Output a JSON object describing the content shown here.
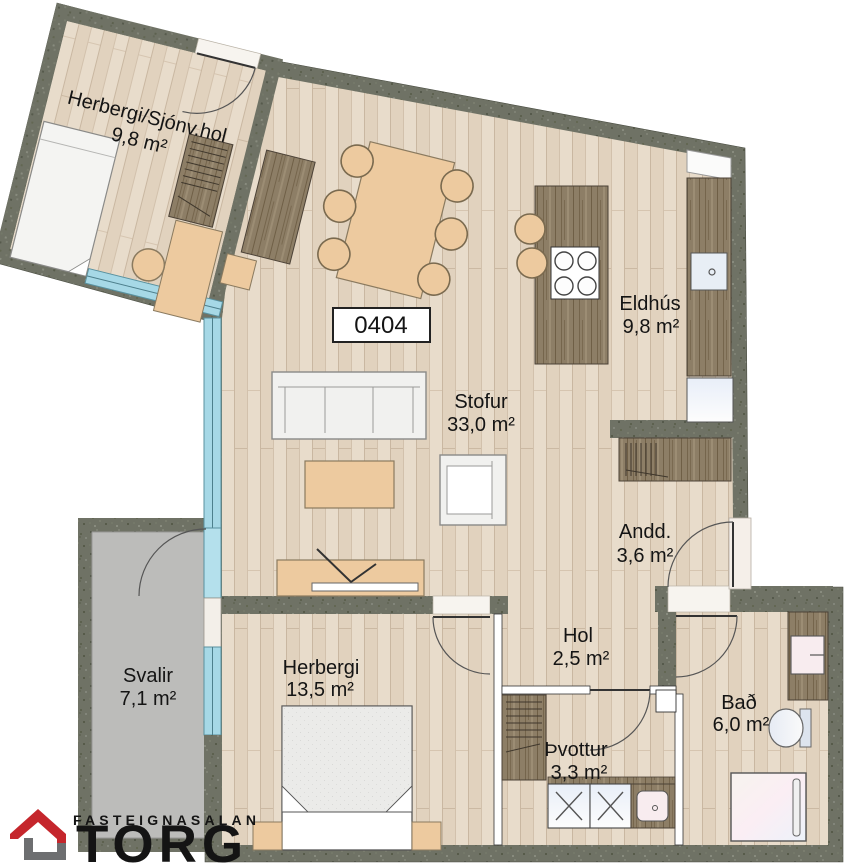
{
  "plan": {
    "unit_label": "0404",
    "rooms": [
      {
        "name": "Herbergi/Sjónv.hol",
        "area": "9,8 m²"
      },
      {
        "name": "Eldhús",
        "area": "9,8 m²"
      },
      {
        "name": "Stofur",
        "area": "33,0 m²"
      },
      {
        "name": "Andd.",
        "area": "3,6 m²"
      },
      {
        "name": "Hol",
        "area": "2,5 m²"
      },
      {
        "name": "Herbergi",
        "area": "13,5 m²"
      },
      {
        "name": "Svalir",
        "area": "7,1 m²"
      },
      {
        "name": "Þvottur",
        "area": "3,3 m²"
      },
      {
        "name": "Bað",
        "area": "6,0 m²"
      }
    ],
    "colors": {
      "wall": "#6f7265",
      "floor_wood": "#e8dccb",
      "dark_wood": "#8d7e66",
      "furniture_tan": "#edca9f",
      "balcony_gray": "#bcbcba",
      "glazing_blue": "#a6d8e6"
    }
  },
  "logo": {
    "line1": "FASTEIGNASALAN",
    "word": "TORG",
    "red": "#c5262c",
    "gray": "#6f7072"
  }
}
